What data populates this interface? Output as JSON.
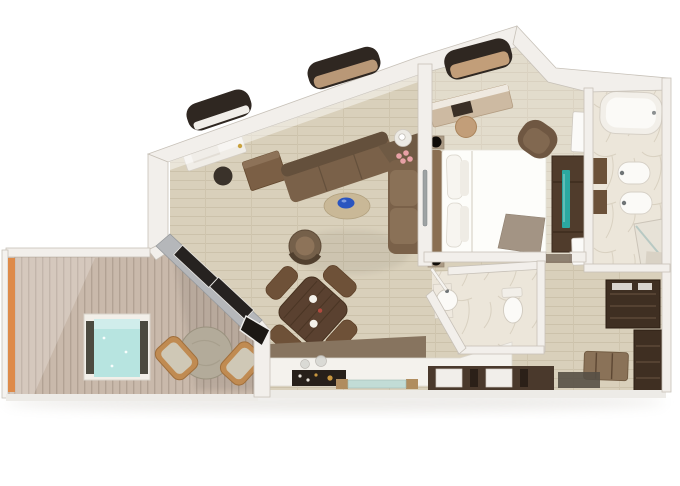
{
  "canvas": {
    "width": 680,
    "height": 486,
    "background": "#ffffff"
  },
  "colors": {
    "wall": "#f2efeb",
    "wall_edge": "#c7c1b8",
    "wall_outer_band": "#edebe7",
    "wood_floor": "#d9d0bb",
    "deck_wood": "#c9b9ab",
    "marble": "#ece6da",
    "pool_water": "#b7e4e0",
    "tv_screen": "#2ba8a1",
    "sofa_brown": "#7a6149",
    "sofa_back": "#64503c",
    "cushion_light": "#8a7157",
    "dark_wood": "#3f2f22",
    "dining_wood": "#5a4130",
    "chair_wood": "#6e5138",
    "bed_white": "#fdfdfa",
    "headboard_tan": "#8a6f52",
    "throw_taupe": "#a39484",
    "cushion_tan": "#c29e79",
    "accent_blue": "#2a55c0",
    "accent_orange": "#de8a49",
    "flower_pink": "#e8a1a6",
    "stone": "#b3ab9a",
    "glass_teal": "#c2dcd6",
    "window_dark": "#2f2721",
    "silver": "#b5b7ba",
    "fixture_white": "#fbfaf7",
    "tray_black": "#27201a",
    "balcony_chair": "#c08b52"
  }
}
